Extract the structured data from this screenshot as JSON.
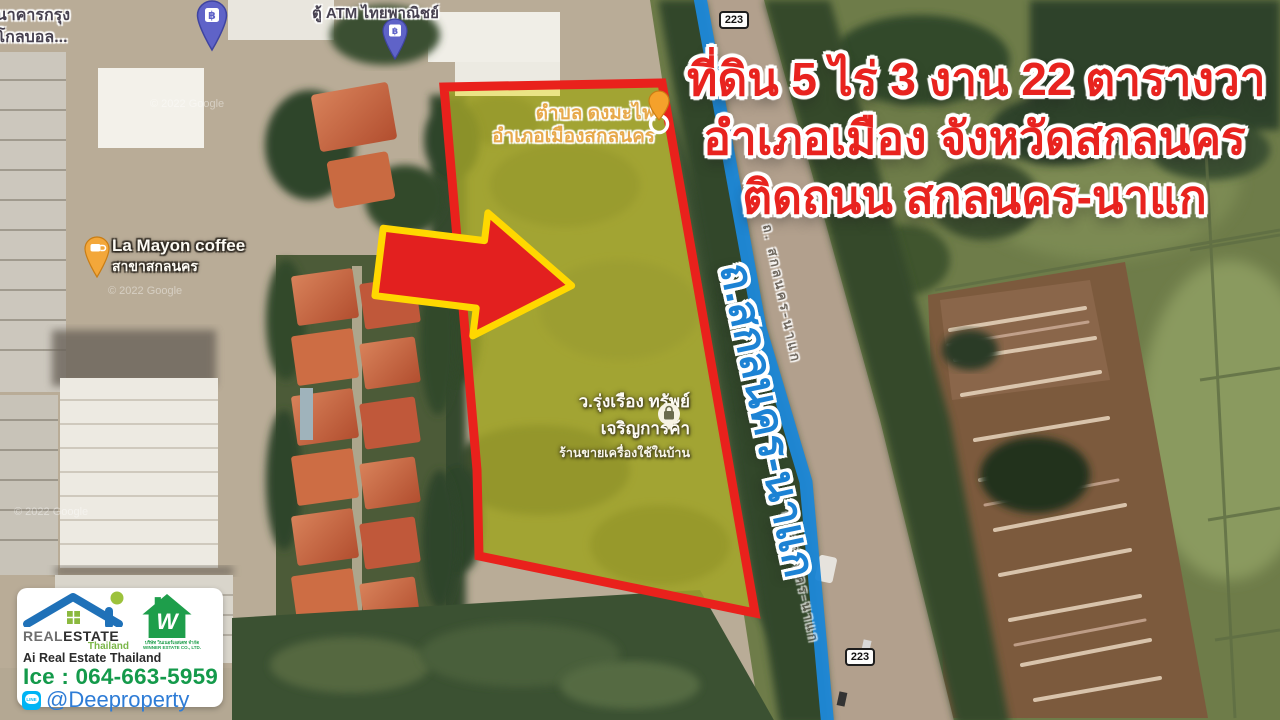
{
  "headline": {
    "line1": "ที่ดิน 5 ไร่ 3 งาน 22 ตารางวา",
    "line2": "อำเภอเมือง จังหวัดสกลนคร",
    "line3": "ติดถนน สกลนคร-นาแก"
  },
  "map": {
    "watermark": "© 2022 Google",
    "route_number": "223",
    "road": {
      "big_label": "ถ.สกลนคร-นาแก",
      "small_label": "ถ. สกลนคร-นาแก"
    },
    "pois": {
      "bank_top_left": {
        "line1": "ธนาคารกรุง",
        "line2": "มโกลบอล..."
      },
      "atm": {
        "name": "ตู้ ATM ไทยพาณิชย์"
      },
      "subdistrict": {
        "line1": "ตำบล ดงมะไฟ",
        "line2": "อำเภอเมืองสกลนคร"
      },
      "coffee": {
        "line1": "La Mayon coffee",
        "line2": "สาขาสกลนคร"
      },
      "shop": {
        "line1": "ว.รุ่งเรือง ทรัพย์",
        "line2": "เจริญการค้า",
        "line3": "ร้านขายเครื่องใช้ในบ้าน"
      }
    }
  },
  "branding": {
    "ai_logo": {
      "brand_left": "REAL",
      "brand_right": "ESTATE",
      "country": "Thailand",
      "subtitle": "Ai Real Estate Thailand"
    },
    "winner_logo": {
      "letter": "W",
      "line1": "บริษัท วินเนอร์เอสเตท จำกัด",
      "line2": "WINNER ESTATE CO., LTD."
    },
    "phone": "Ice : 064-663-5959",
    "line": {
      "label": "LINE",
      "id": "@Deeproperty"
    }
  },
  "icons": {
    "baht": "฿"
  },
  "colors": {
    "headline_red": "#e8231f",
    "road_blue": "#1e87d6",
    "plot_yellow": "#e8de28",
    "plot_border": "#e9211c",
    "arrow_red": "#e3201f",
    "arrow_outline": "#ffd800",
    "phone_green": "#149a4b",
    "line_blue": "#2e7cd6"
  }
}
